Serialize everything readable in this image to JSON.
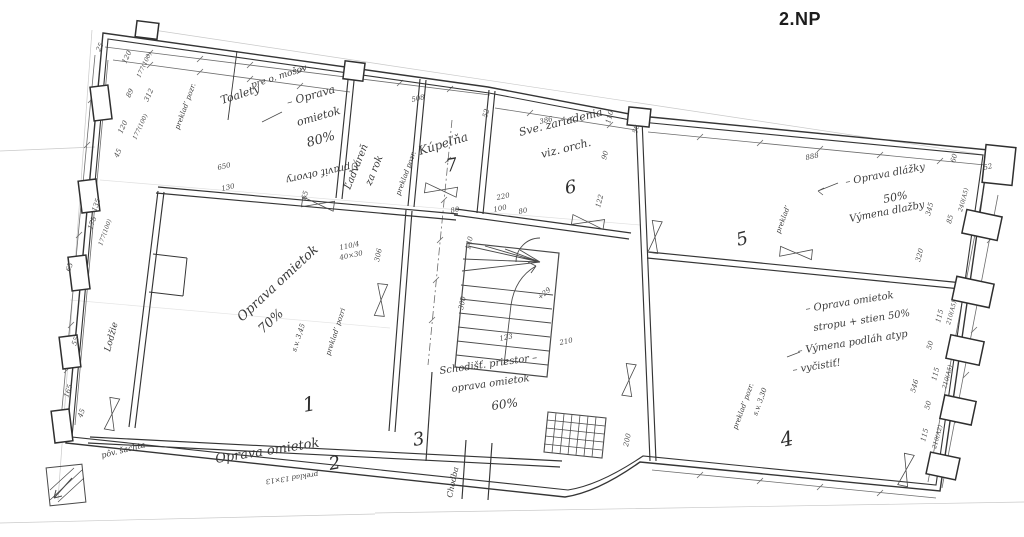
{
  "title": "2.NP",
  "rooms": [
    "1",
    "2",
    "3",
    "4",
    "5",
    "6",
    "7"
  ],
  "colors": {
    "ink": "#353535",
    "pencil": "#c9c9c9",
    "paper": "#ffffff"
  },
  "plan": {
    "labels": [
      {
        "text": "Toalety",
        "x": 222,
        "y": 104,
        "rot": -18,
        "size": 11,
        "kind": "hand"
      },
      {
        "text": "pre o. mošov",
        "x": 252,
        "y": 88,
        "rot": -18,
        "size": 9,
        "kind": "hand"
      },
      {
        "text": "– Oprava",
        "x": 288,
        "y": 106,
        "rot": -16,
        "size": 11,
        "kind": "hand"
      },
      {
        "text": "omietok",
        "x": 298,
        "y": 126,
        "rot": -16,
        "size": 11,
        "kind": "hand"
      },
      {
        "text": "80%",
        "x": 308,
        "y": 147,
        "rot": -16,
        "size": 13,
        "kind": "hand"
      },
      {
        "text": "Upraviť otvory",
        "x": 358,
        "y": 162,
        "rot": 168,
        "size": 10,
        "kind": "hand"
      },
      {
        "text": "Ľadváreň",
        "x": 350,
        "y": 190,
        "rot": -68,
        "size": 10,
        "kind": "hand"
      },
      {
        "text": "za rok",
        "x": 371,
        "y": 186,
        "rot": -68,
        "size": 10,
        "kind": "hand"
      },
      {
        "text": "preklad pozr.",
        "x": 400,
        "y": 196,
        "rot": -70,
        "size": 7,
        "kind": "hand"
      },
      {
        "text": "Kúpeľňa",
        "x": 420,
        "y": 155,
        "rot": -17,
        "size": 12,
        "kind": "hand"
      },
      {
        "text": "7",
        "x": 447,
        "y": 172,
        "rot": -10,
        "size": 18,
        "kind": "room"
      },
      {
        "text": "Sve. zariadenia",
        "x": 520,
        "y": 136,
        "rot": -14,
        "size": 11,
        "kind": "hand"
      },
      {
        "text": "viz. orch.",
        "x": 542,
        "y": 158,
        "rot": -14,
        "size": 11,
        "kind": "hand"
      },
      {
        "text": "6",
        "x": 566,
        "y": 194,
        "rot": -10,
        "size": 18,
        "kind": "room"
      },
      {
        "text": "– Oprava dlážky",
        "x": 846,
        "y": 185,
        "rot": -11,
        "size": 10,
        "kind": "hand"
      },
      {
        "text": "50%",
        "x": 884,
        "y": 203,
        "rot": -11,
        "size": 11,
        "kind": "hand"
      },
      {
        "text": "Výmena dlažby",
        "x": 850,
        "y": 222,
        "rot": -11,
        "size": 10,
        "kind": "hand"
      },
      {
        "text": "5",
        "x": 738,
        "y": 246,
        "rot": -14,
        "size": 18,
        "kind": "room"
      },
      {
        "text": "preklad’",
        "x": 780,
        "y": 234,
        "rot": -70,
        "size": 7,
        "kind": "hand"
      },
      {
        "text": "– Oprava omietok",
        "x": 806,
        "y": 312,
        "rot": -9,
        "size": 10,
        "kind": "hand"
      },
      {
        "text": "stropu + stien 50%",
        "x": 814,
        "y": 331,
        "rot": -9,
        "size": 10,
        "kind": "hand"
      },
      {
        "text": "– Výmena podláh atyp",
        "x": 798,
        "y": 354,
        "rot": -9,
        "size": 10,
        "kind": "hand"
      },
      {
        "text": "– vyčistiť!",
        "x": 793,
        "y": 373,
        "rot": -9,
        "size": 10,
        "kind": "hand"
      },
      {
        "text": "4",
        "x": 782,
        "y": 447,
        "rot": -12,
        "size": 20,
        "kind": "room"
      },
      {
        "text": "preklad’ pozr.",
        "x": 737,
        "y": 430,
        "rot": -70,
        "size": 7,
        "kind": "hand"
      },
      {
        "text": "s.v. 3,30",
        "x": 757,
        "y": 416,
        "rot": -70,
        "size": 7,
        "kind": "hand"
      },
      {
        "text": "Oprava omietok",
        "x": 242,
        "y": 322,
        "rot": -43,
        "size": 13,
        "kind": "hand"
      },
      {
        "text": "70%",
        "x": 263,
        "y": 334,
        "rot": -43,
        "size": 13,
        "kind": "hand"
      },
      {
        "text": "s.v. 3,45",
        "x": 296,
        "y": 352,
        "rot": -72,
        "size": 7,
        "kind": "hand"
      },
      {
        "text": "preklad’ pozri",
        "x": 330,
        "y": 356,
        "rot": -72,
        "size": 7,
        "kind": "hand"
      },
      {
        "text": "1",
        "x": 304,
        "y": 412,
        "rot": -10,
        "size": 20,
        "kind": "room"
      },
      {
        "text": "Lodžie",
        "x": 110,
        "y": 352,
        "rot": -75,
        "size": 9,
        "kind": "hand"
      },
      {
        "text": "pôv. šachta",
        "x": 102,
        "y": 458,
        "rot": -14,
        "size": 8,
        "kind": "hand"
      },
      {
        "text": "Oprava omietok",
        "x": 216,
        "y": 463,
        "rot": -9,
        "size": 13,
        "kind": "hand"
      },
      {
        "text": "2",
        "x": 330,
        "y": 470,
        "rot": -10,
        "size": 18,
        "kind": "room"
      },
      {
        "text": "preklad 13×13",
        "x": 318,
        "y": 472,
        "rot": 172,
        "size": 7,
        "kind": "hand"
      },
      {
        "text": "Schodišť. priestor –",
        "x": 440,
        "y": 374,
        "rot": -8,
        "size": 10,
        "kind": "hand"
      },
      {
        "text": "oprava omietok",
        "x": 452,
        "y": 392,
        "rot": -8,
        "size": 10,
        "kind": "hand"
      },
      {
        "text": "60%",
        "x": 492,
        "y": 410,
        "rot": -8,
        "size": 12,
        "kind": "hand"
      },
      {
        "text": "3",
        "x": 414,
        "y": 446,
        "rot": -10,
        "size": 18,
        "kind": "room"
      },
      {
        "text": "Chodba",
        "x": 452,
        "y": 498,
        "rot": -78,
        "size": 8,
        "kind": "hand"
      },
      {
        "text": "preklad’ pozr.",
        "x": 179,
        "y": 130,
        "rot": -70,
        "size": 7,
        "kind": "hand"
      },
      {
        "text": "25",
        "x": 100,
        "y": 52,
        "rot": -65,
        "size": 7,
        "kind": "dim"
      },
      {
        "text": "120",
        "x": 126,
        "y": 64,
        "rot": -65,
        "size": 7,
        "kind": "dim"
      },
      {
        "text": "177(100)",
        "x": 140,
        "y": 78,
        "rot": -65,
        "size": 6,
        "kind": "dim"
      },
      {
        "text": "89",
        "x": 130,
        "y": 98,
        "rot": -65,
        "size": 7,
        "kind": "dim"
      },
      {
        "text": "312",
        "x": 148,
        "y": 102,
        "rot": -65,
        "size": 7,
        "kind": "dim"
      },
      {
        "text": "120",
        "x": 122,
        "y": 134,
        "rot": -65,
        "size": 7,
        "kind": "dim"
      },
      {
        "text": "177(100)",
        "x": 136,
        "y": 140,
        "rot": -65,
        "size": 6,
        "kind": "dim"
      },
      {
        "text": "45",
        "x": 118,
        "y": 158,
        "rot": -65,
        "size": 7,
        "kind": "dim"
      },
      {
        "text": "650",
        "x": 218,
        "y": 170,
        "rot": -13,
        "size": 7,
        "kind": "dim"
      },
      {
        "text": "130",
        "x": 222,
        "y": 191,
        "rot": -13,
        "size": 7,
        "kind": "dim"
      },
      {
        "text": "65",
        "x": 306,
        "y": 200,
        "rot": -75,
        "size": 7,
        "kind": "dim"
      },
      {
        "text": "508",
        "x": 412,
        "y": 102,
        "rot": -13,
        "size": 7,
        "kind": "dim"
      },
      {
        "text": "52",
        "x": 487,
        "y": 118,
        "rot": -75,
        "size": 7,
        "kind": "dim"
      },
      {
        "text": "386",
        "x": 540,
        "y": 124,
        "rot": -13,
        "size": 7,
        "kind": "dim"
      },
      {
        "text": "110",
        "x": 610,
        "y": 124,
        "rot": -75,
        "size": 7,
        "kind": "dim"
      },
      {
        "text": "50",
        "x": 637,
        "y": 134,
        "rot": -75,
        "size": 7,
        "kind": "dim"
      },
      {
        "text": "90",
        "x": 606,
        "y": 160,
        "rot": -75,
        "size": 7,
        "kind": "dim"
      },
      {
        "text": "220",
        "x": 497,
        "y": 200,
        "rot": -12,
        "size": 7,
        "kind": "dim"
      },
      {
        "text": "100",
        "x": 494,
        "y": 212,
        "rot": -12,
        "size": 7,
        "kind": "dim"
      },
      {
        "text": "80",
        "x": 519,
        "y": 214,
        "rot": -12,
        "size": 7,
        "kind": "dim"
      },
      {
        "text": "122",
        "x": 600,
        "y": 208,
        "rot": -75,
        "size": 7,
        "kind": "dim"
      },
      {
        "text": "888",
        "x": 806,
        "y": 160,
        "rot": -12,
        "size": 7,
        "kind": "dim"
      },
      {
        "text": "345",
        "x": 930,
        "y": 216,
        "rot": -75,
        "size": 7,
        "kind": "dim"
      },
      {
        "text": "60",
        "x": 955,
        "y": 163,
        "rot": -75,
        "size": 7,
        "kind": "dim"
      },
      {
        "text": "52",
        "x": 984,
        "y": 170,
        "rot": -13,
        "size": 7,
        "kind": "dim"
      },
      {
        "text": "85",
        "x": 951,
        "y": 224,
        "rot": -75,
        "size": 7,
        "kind": "dim"
      },
      {
        "text": "240(A5)",
        "x": 962,
        "y": 212,
        "rot": -75,
        "size": 6,
        "kind": "dim"
      },
      {
        "text": "320",
        "x": 920,
        "y": 262,
        "rot": -75,
        "size": 7,
        "kind": "dim"
      },
      {
        "text": "115",
        "x": 940,
        "y": 323,
        "rot": -75,
        "size": 7,
        "kind": "dim"
      },
      {
        "text": "210(A5)",
        "x": 950,
        "y": 325,
        "rot": -75,
        "size": 6,
        "kind": "dim"
      },
      {
        "text": "50",
        "x": 931,
        "y": 350,
        "rot": -75,
        "size": 7,
        "kind": "dim"
      },
      {
        "text": "115",
        "x": 936,
        "y": 381,
        "rot": -75,
        "size": 7,
        "kind": "dim"
      },
      {
        "text": "210(A5)",
        "x": 946,
        "y": 389,
        "rot": -75,
        "size": 6,
        "kind": "dim"
      },
      {
        "text": "50",
        "x": 929,
        "y": 410,
        "rot": -75,
        "size": 7,
        "kind": "dim"
      },
      {
        "text": "115",
        "x": 925,
        "y": 442,
        "rot": -75,
        "size": 7,
        "kind": "dim"
      },
      {
        "text": "210(A2)",
        "x": 936,
        "y": 449,
        "rot": -75,
        "size": 6,
        "kind": "dim"
      },
      {
        "text": "546",
        "x": 915,
        "y": 393,
        "rot": -75,
        "size": 7,
        "kind": "dim"
      },
      {
        "text": "306",
        "x": 379,
        "y": 262,
        "rot": -78,
        "size": 7,
        "kind": "dim"
      },
      {
        "text": "140",
        "x": 470,
        "y": 250,
        "rot": -78,
        "size": 7,
        "kind": "dim"
      },
      {
        "text": "300",
        "x": 463,
        "y": 310,
        "rot": -78,
        "size": 7,
        "kind": "dim"
      },
      {
        "text": "80",
        "x": 451,
        "y": 213,
        "rot": -12,
        "size": 7,
        "kind": "dim"
      },
      {
        "text": "123",
        "x": 500,
        "y": 341,
        "rot": -12,
        "size": 7,
        "kind": "dim"
      },
      {
        "text": "210",
        "x": 560,
        "y": 345,
        "rot": -12,
        "size": 7,
        "kind": "dim"
      },
      {
        "text": "110/4",
        "x": 340,
        "y": 250,
        "rot": -12,
        "size": 7,
        "kind": "dim"
      },
      {
        "text": "40×30",
        "x": 340,
        "y": 260,
        "rot": -12,
        "size": 7,
        "kind": "dim"
      },
      {
        "text": "+29",
        "x": 540,
        "y": 300,
        "rot": -40,
        "size": 7,
        "kind": "dim"
      },
      {
        "text": "200",
        "x": 628,
        "y": 447,
        "rot": -78,
        "size": 7,
        "kind": "dim"
      },
      {
        "text": "175",
        "x": 92,
        "y": 230,
        "rot": -70,
        "size": 7,
        "kind": "dim"
      },
      {
        "text": "177(100)",
        "x": 102,
        "y": 246,
        "rot": -70,
        "size": 6,
        "kind": "dim"
      },
      {
        "text": "135",
        "x": 96,
        "y": 212,
        "rot": -70,
        "size": 7,
        "kind": "dim"
      },
      {
        "text": "65",
        "x": 70,
        "y": 272,
        "rot": -70,
        "size": 7,
        "kind": "dim"
      },
      {
        "text": "55",
        "x": 76,
        "y": 346,
        "rot": -70,
        "size": 7,
        "kind": "dim"
      },
      {
        "text": "165",
        "x": 68,
        "y": 398,
        "rot": -70,
        "size": 7,
        "kind": "dim"
      },
      {
        "text": "45",
        "x": 82,
        "y": 418,
        "rot": -70,
        "size": 7,
        "kind": "dim"
      }
    ]
  }
}
